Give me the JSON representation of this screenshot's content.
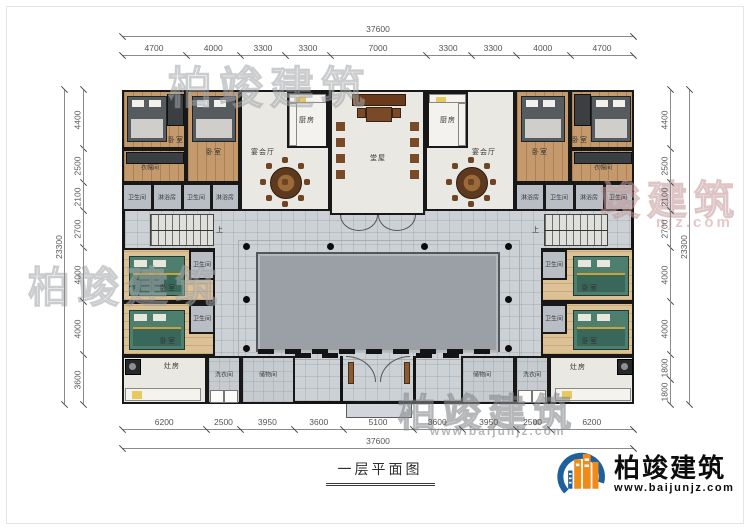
{
  "title": "一层平面图",
  "brand": {
    "name": "柏竣建筑",
    "url": "www.baijunjz.com"
  },
  "watermarks": {
    "top": "柏竣建筑",
    "left": "柏竣建筑",
    "right": "竣建筑",
    "right_sub": "njz.com",
    "bottom": "柏竣建筑",
    "bottom_sub": "www.baijunjz.com"
  },
  "dimensions": {
    "top": {
      "total": "37600",
      "segments": [
        "4700",
        "4000",
        "3300",
        "3300",
        "7000",
        "3300",
        "3300",
        "4000",
        "4700"
      ]
    },
    "bottom": {
      "total": "37600",
      "segments": [
        "6200",
        "2500",
        "3950",
        "3600",
        "5100",
        "3600",
        "3950",
        "2500",
        "6200"
      ]
    },
    "left": {
      "total": "23300",
      "segments": [
        "4400",
        "2500",
        "2100",
        "2700",
        "4000",
        "4000",
        "3600"
      ]
    },
    "right": {
      "total": "23300",
      "segments": [
        "4400",
        "2500",
        "2100",
        "2700",
        "4000",
        "4000",
        "1800",
        "1800"
      ]
    }
  },
  "rooms": [
    {
      "label": "卧室"
    },
    {
      "label": "卧室"
    },
    {
      "label": "衣帽间"
    },
    {
      "label": "卫生间"
    },
    {
      "label": "淋浴房"
    },
    {
      "label": "卫生间"
    },
    {
      "label": "淋浴房"
    },
    {
      "label": "厨房"
    },
    {
      "label": "宴会厅"
    },
    {
      "label": "堂屋"
    },
    {
      "label": "厨房"
    },
    {
      "label": "宴会厅"
    },
    {
      "label": "卧室"
    },
    {
      "label": "卧室"
    },
    {
      "label": "衣帽间"
    },
    {
      "label": "淋浴房"
    },
    {
      "label": "卫生间"
    },
    {
      "label": "淋浴房"
    },
    {
      "label": "卫生间"
    },
    {
      "label": "上"
    },
    {
      "label": "上"
    },
    {
      "label": "卧室"
    },
    {
      "label": "卫生间"
    },
    {
      "label": "卧室"
    },
    {
      "label": "卫生间"
    },
    {
      "label": "卫生间"
    },
    {
      "label": "卧室"
    },
    {
      "label": "卫生间"
    },
    {
      "label": "卧室"
    },
    {
      "label": "灶房"
    },
    {
      "label": "洗衣间"
    },
    {
      "label": "储物间"
    },
    {
      "label": "储物间"
    },
    {
      "label": "洗衣间"
    },
    {
      "label": "灶房"
    }
  ]
}
